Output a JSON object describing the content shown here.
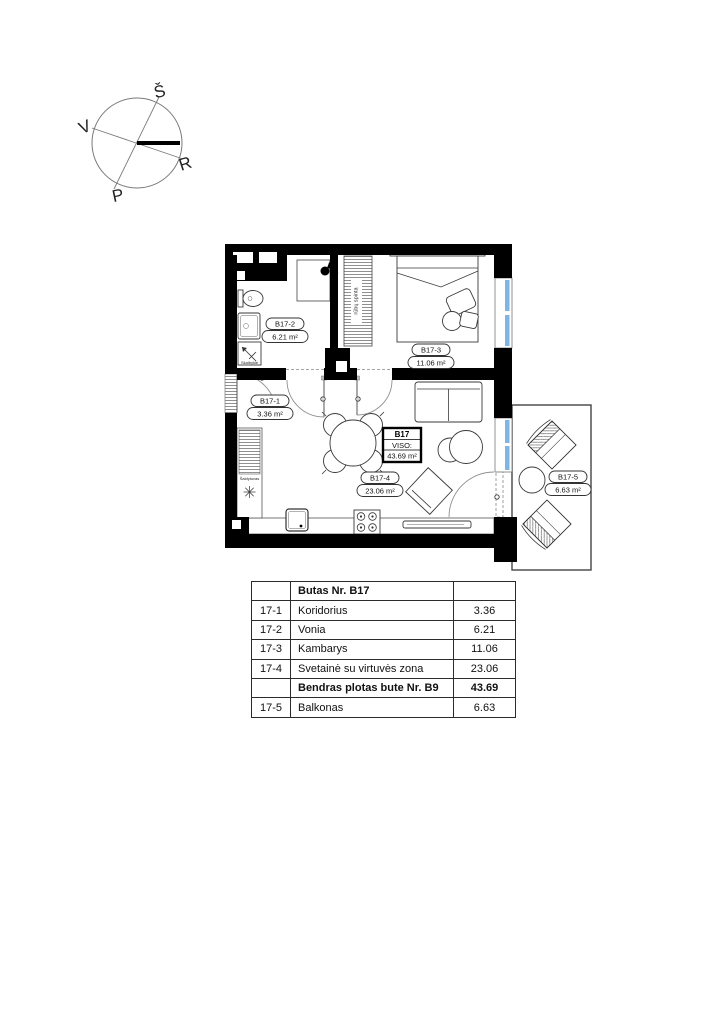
{
  "compass": {
    "north": "Š",
    "west": "V",
    "east": "R",
    "south": "P"
  },
  "plan": {
    "unit_box": {
      "id": "B17",
      "viso_label": "VISO:",
      "total_area": "43.69 m²"
    },
    "rooms": [
      {
        "id": "B17-1",
        "area": "3.36 m²"
      },
      {
        "id": "B17-2",
        "area": "6.21 m²"
      },
      {
        "id": "B17-3",
        "area": "11.06 m²"
      },
      {
        "id": "B17-4",
        "area": "23.06 m²"
      },
      {
        "id": "B17-5",
        "area": "6.63 m²"
      }
    ],
    "annotations": {
      "wardrobe": "rūbų spinta",
      "fridge": "Šaldytuvas",
      "washer": "Skalbyklė"
    }
  },
  "area_table": {
    "header": {
      "no": "",
      "name": "Butas Nr. B17",
      "value": ""
    },
    "rows": [
      {
        "no": "17-1",
        "name": "Koridorius",
        "value": "3.36"
      },
      {
        "no": "17-2",
        "name": "Vonia",
        "value": "6.21"
      },
      {
        "no": "17-3",
        "name": "Kambarys",
        "value": "11.06"
      },
      {
        "no": "17-4",
        "name": "Svetainė su virtuvės  zona",
        "value": "23.06"
      },
      {
        "no": "",
        "name": "Bendras plotas  bute Nr. B9",
        "value": "43.69"
      },
      {
        "no": "17-5",
        "name": "Balkonas",
        "value": "6.63"
      }
    ]
  },
  "colors": {
    "wall": "#000000",
    "window": "#7FB5E5"
  }
}
